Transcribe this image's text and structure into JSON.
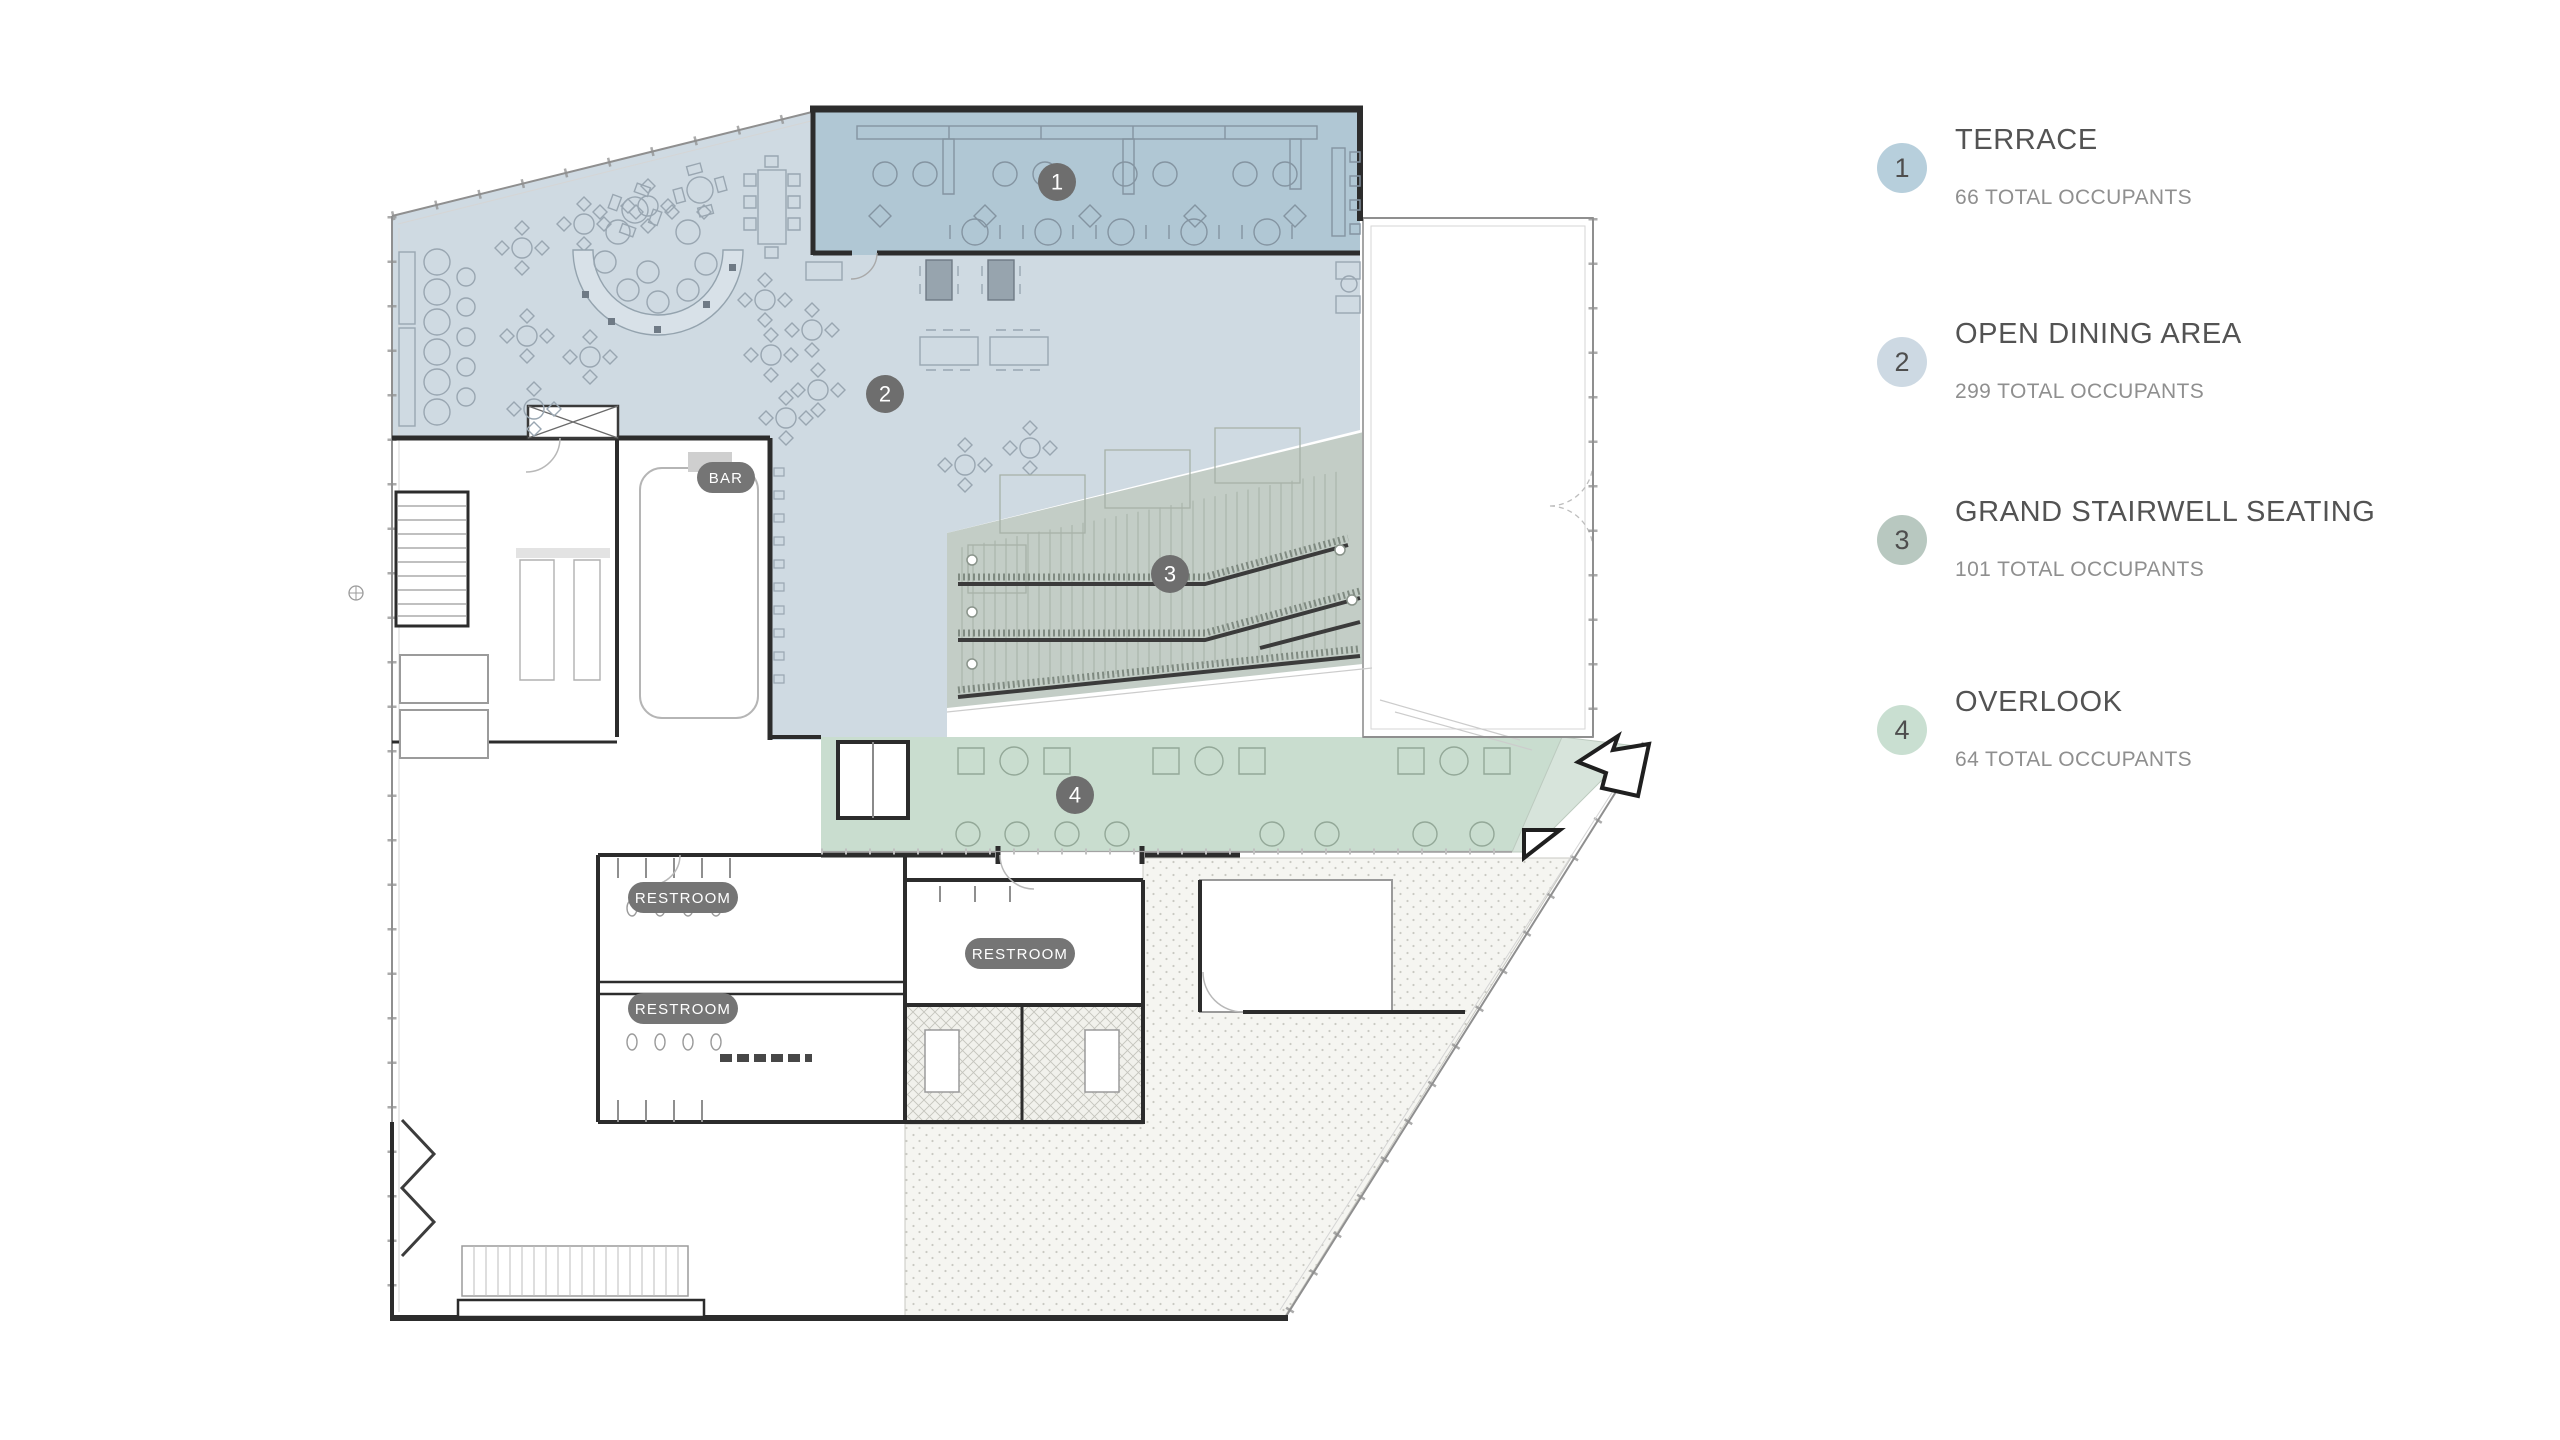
{
  "page": {
    "background": "#ffffff"
  },
  "legend": {
    "items": [
      {
        "number": "1",
        "title": "TERRACE",
        "occupancy": "66 TOTAL OCCUPANTS",
        "circle_color": "#b7cfdc"
      },
      {
        "number": "2",
        "title": "OPEN DINING AREA",
        "occupancy": "299 TOTAL OCCUPANTS",
        "circle_color": "#cdd9e3"
      },
      {
        "number": "3",
        "title": "GRAND STAIRWELL SEATING",
        "occupancy": "101 TOTAL OCCUPANTS",
        "circle_color": "#b8c8c0"
      },
      {
        "number": "4",
        "title": "OVERLOOK",
        "occupancy": "64 TOTAL OCCUPANTS",
        "circle_color": "#c9dfd1"
      }
    ]
  },
  "plan": {
    "badges": [
      {
        "number": "1",
        "zone": "terrace"
      },
      {
        "number": "2",
        "zone": "open-dining-area"
      },
      {
        "number": "3",
        "zone": "grand-stairwell-seating"
      },
      {
        "number": "4",
        "zone": "overlook"
      }
    ],
    "badge_color": "#6e6e6e",
    "labels": {
      "bar": "BAR",
      "restroom": "RESTROOM"
    },
    "pill_color": "#757575",
    "zone_colors": {
      "terrace": "#b0c7d4",
      "open_dining": "#cfdae2",
      "grand_stairwell": "#c3cdc6",
      "overlook": "#c9ddcf"
    }
  }
}
